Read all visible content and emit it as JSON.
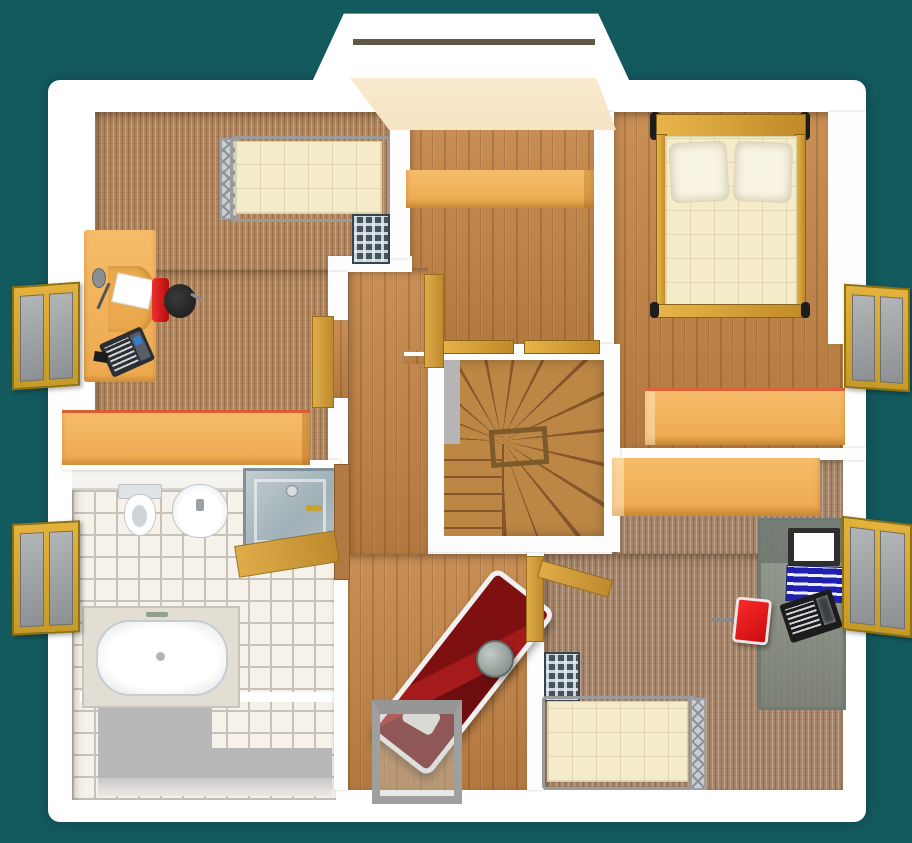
{
  "scene": {
    "type": "3d-floor-plan-render",
    "view": "top-down",
    "visible_text": "none"
  },
  "palette": {
    "bg": "#135a5f",
    "wall": "#fdfdfd",
    "wood_floor": "#c0854a",
    "carpet": "#b2875f",
    "tile": "#f6f2ea",
    "tile_grout": "#c6c2ba",
    "furniture_orange": "#f6bc6a",
    "gold_frame": "#d8a637",
    "mattress_cream": "#f4ebc8",
    "red_chair": "#e01212",
    "lounger_red": "#8e1114",
    "radiator_dark": "#46525c",
    "stairs_wood": "#b2793c",
    "stairs_edge": "#85562a",
    "gray_area": "#b8b8b8",
    "shower_glass": "#9fb0b6",
    "dormer_beam": "#5f5846",
    "roof_slope_cream": "#f6e4c2"
  },
  "rooms": [
    {
      "id": "bedroom-top-left",
      "floor": "carpet"
    },
    {
      "id": "middle-room",
      "floor": "wood"
    },
    {
      "id": "bedroom-top-right",
      "floor": "wood"
    },
    {
      "id": "bedroom-bottom-right",
      "floor": "carpet"
    },
    {
      "id": "bathroom",
      "floor": "tiles"
    },
    {
      "id": "hallway",
      "floor": "wood"
    },
    {
      "id": "stairwell",
      "floor": "wood-winder-stairs"
    }
  ],
  "furniture": {
    "bedroom_top_left": [
      "single-bed",
      "radiator",
      "desk",
      "desk-lamp",
      "laptop",
      "paper-sheet",
      "office-chair-red",
      "sideboard"
    ],
    "middle_room": [
      "sideboard"
    ],
    "bedroom_top_right": [
      "double-bed",
      "pillow-left",
      "pillow-right",
      "bench"
    ],
    "bedroom_bottom_right": [
      "wardrobe",
      "computer-desk-glass",
      "monitor",
      "blue-binders",
      "laptop-black",
      "chair-red",
      "radiator",
      "single-bed"
    ],
    "bathroom": [
      "toilet",
      "washbasin",
      "shower-cabin",
      "bathtub"
    ],
    "hallway": [
      "sun-lounger-red",
      "round-side-table",
      "console-table"
    ],
    "stairwell": [
      "winder-staircase",
      "handrail"
    ]
  },
  "openings": {
    "windows": [
      "left-top-casement",
      "left-bottom-casement",
      "right-top-casement",
      "right-bottom-casement"
    ],
    "doors": [
      "bedroom-top-left-door",
      "middle-room-door",
      "bedroom-bottom-right-door",
      "bathroom-door"
    ],
    "thresholds": [
      "stair-landing-threshold-left",
      "stair-landing-threshold-right"
    ],
    "dormer": "top-center-dormer"
  }
}
